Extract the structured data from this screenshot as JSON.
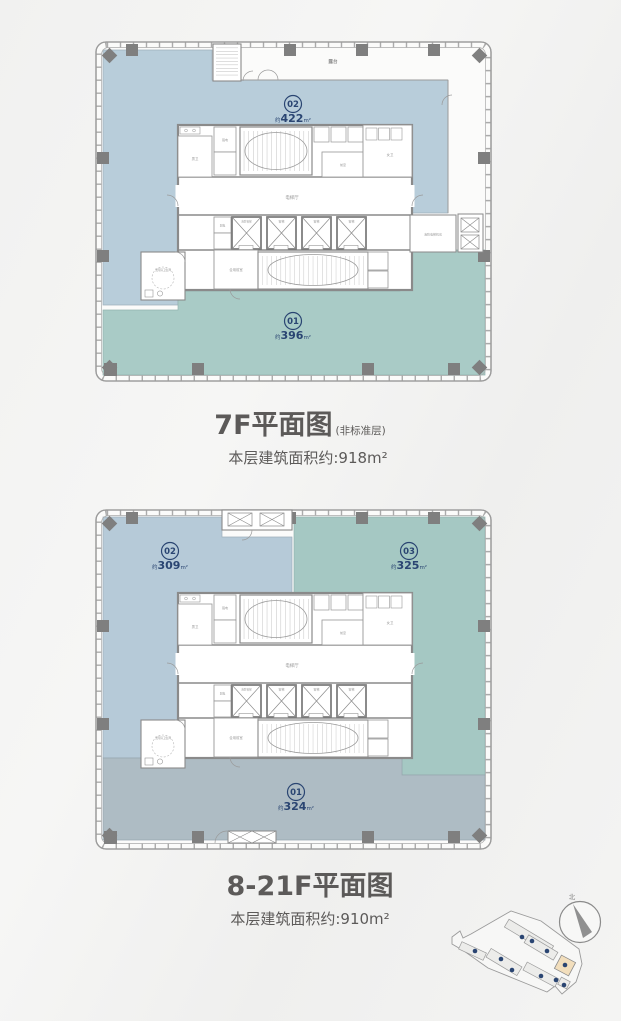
{
  "plan7f": {
    "title": "7F平面图",
    "title_note": "(非标准层)",
    "area_text": "本层建筑面积约:918m²",
    "zones": {
      "z02": {
        "num": "02",
        "prefix": "约",
        "value": "422",
        "unit": "m²"
      },
      "z01": {
        "num": "01",
        "prefix": "约",
        "value": "396",
        "unit": "m²"
      }
    }
  },
  "plan8f": {
    "title": "8-21F平面图",
    "area_text": "本层建筑面积约:910m²",
    "zones": {
      "z02": {
        "num": "02",
        "prefix": "约",
        "value": "309",
        "unit": "m²"
      },
      "z03": {
        "num": "03",
        "prefix": "约",
        "value": "325",
        "unit": "m²"
      },
      "z01": {
        "num": "01",
        "prefix": "约",
        "value": "324",
        "unit": "m²"
      }
    }
  },
  "rooms": {
    "terrace": "露台",
    "elevator_hall": "电梯厅",
    "passenger_elevator": "客梯",
    "fire_elevator": "消防客梯",
    "shared_front_room": "合用前室",
    "front_room": "前室",
    "male_wc": "男卫",
    "female_wc": "女卫",
    "accessible_wc": "无障碍卫生间",
    "fire_elevator_machine_room": "消防电梯机房",
    "strong_electric": "强电",
    "weak_electric": "弱电"
  },
  "site_map": {
    "north_label": "北"
  },
  "colors": {
    "zone_blue": "#b8cdda",
    "zone_teal": "#a9cbc6",
    "zone_gray": "#aebcc4",
    "badge_navy": "#2a4572",
    "highlight_tan": "#f2debc"
  }
}
